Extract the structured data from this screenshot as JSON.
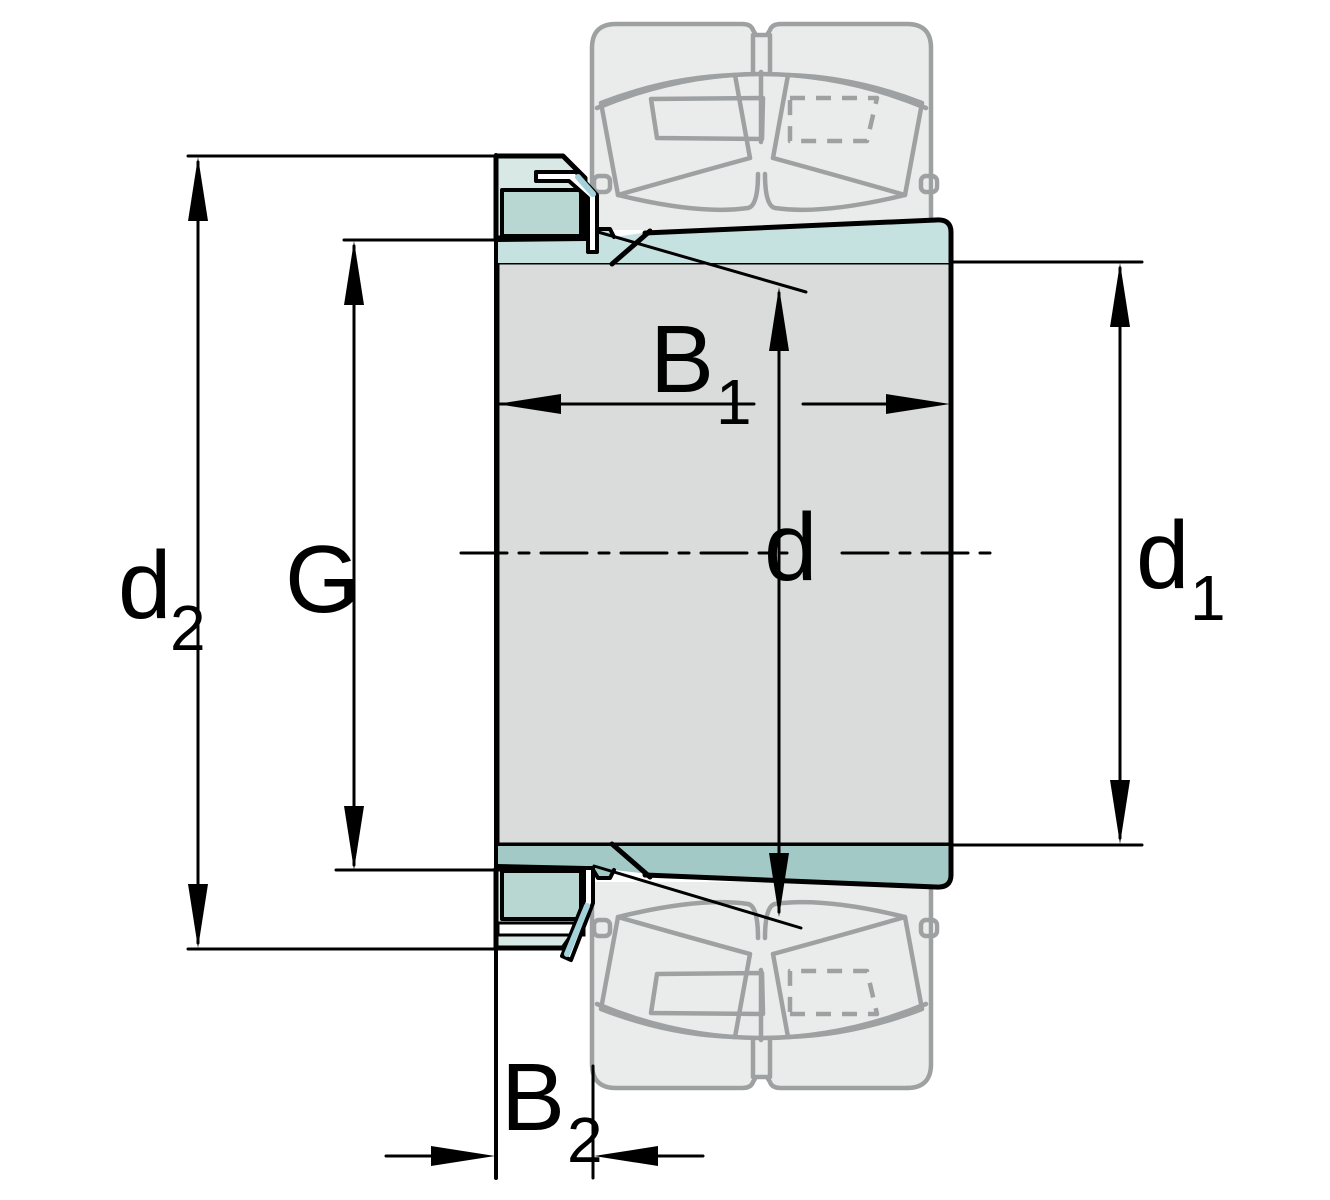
{
  "figure": {
    "type": "engineering-cross-section",
    "subject": "Adapter sleeve with lock nut and locking washer; spherical roller bearing shown ghosted above and below the shaft centerline",
    "dimension_labels": {
      "d2": {
        "base": "d",
        "sub": "2"
      },
      "G": {
        "base": "G",
        "sub": ""
      },
      "B1": {
        "base": "B",
        "sub": "1"
      },
      "d": {
        "base": "d",
        "sub": ""
      },
      "d1": {
        "base": "d",
        "sub": "1"
      },
      "B2": {
        "base": "B",
        "sub": "2"
      }
    },
    "colors": {
      "background": "#ffffff",
      "line_black": "#000000",
      "body_gray": "#dadcdc",
      "ghost_fill": "#eaebeb",
      "ghost_stroke": "#9da1a1",
      "sleeve_taper_top": "#c6e2e0",
      "sleeve_taper_bottom": "#a2c9c6",
      "nut_outer": "#d8e8e4",
      "nut_inner": "#b9d7d2",
      "washer_fill": "#ffffff",
      "washer_highlight": "#a3d2da"
    }
  }
}
